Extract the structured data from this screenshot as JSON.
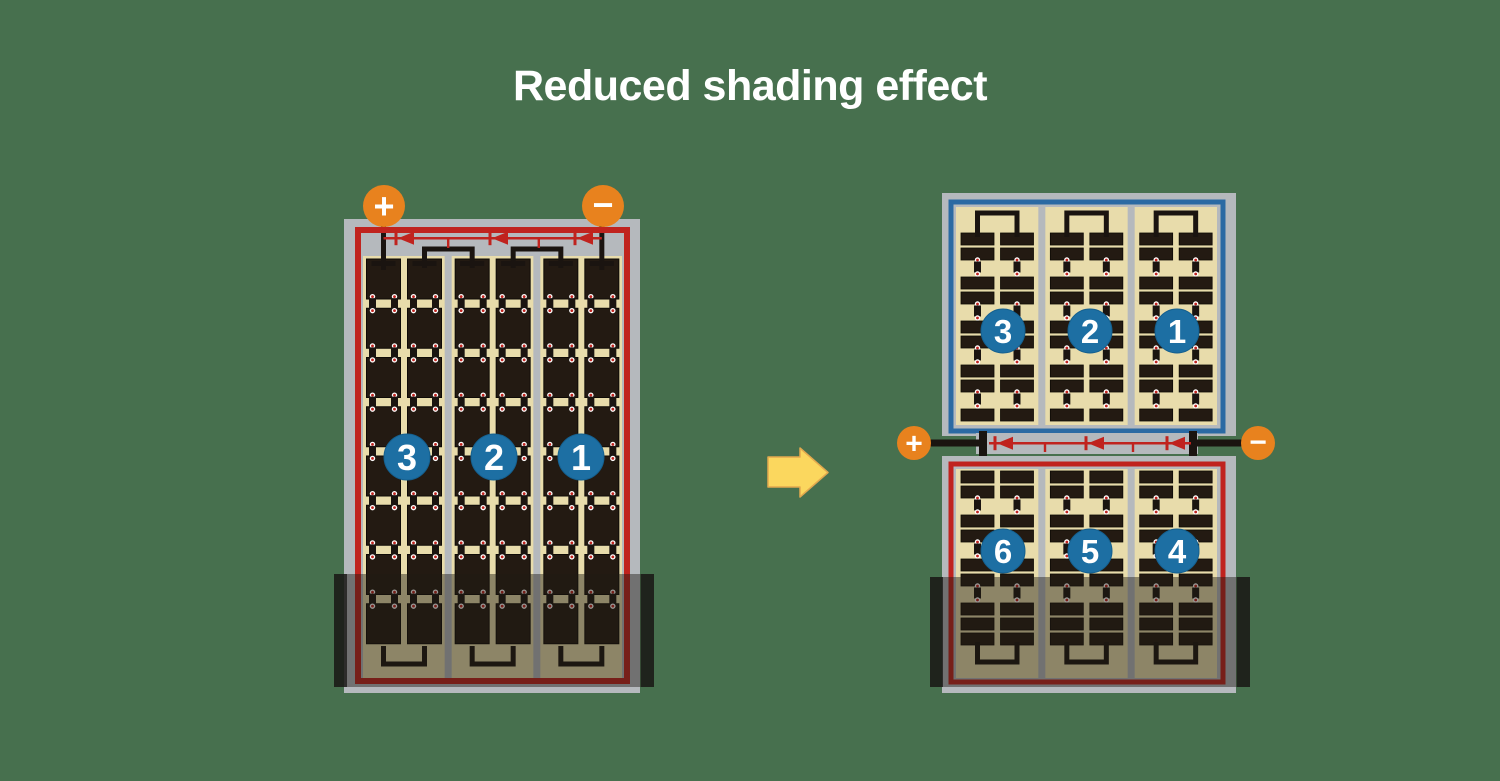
{
  "title": "Reduced shading effect",
  "colors": {
    "background": "#47704e",
    "frame_gray": "#b5b9bd",
    "cell_area_cream": "#e8dcab",
    "cell_dark": "#231a12",
    "wire_red": "#c0231e",
    "wire_blue": "#2b6aa3",
    "wire_black": "#1a1410",
    "terminal_orange": "#e8821e",
    "number_circle_blue": "#1d6fa3",
    "arrow_yellow": "#fbd75e"
  },
  "left_panel": {
    "terminal_positive": "+",
    "terminal_negative": "−",
    "section_labels": [
      "3",
      "2",
      "1"
    ]
  },
  "right_panel": {
    "terminal_positive": "+",
    "terminal_negative": "−",
    "top_section_labels": [
      "3",
      "2",
      "1"
    ],
    "bottom_section_labels": [
      "6",
      "5",
      "4"
    ]
  }
}
